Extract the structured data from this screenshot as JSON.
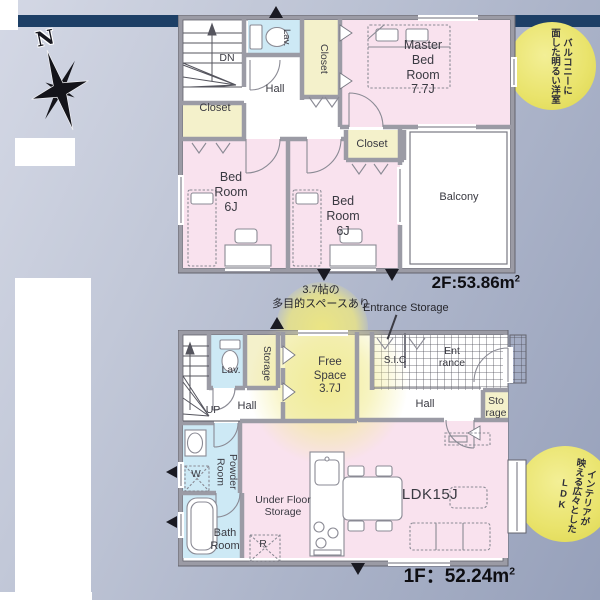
{
  "colors": {
    "top_bar": "#1d3f66",
    "wall": "#9b9ba5",
    "room_pink": "#f9e2ee",
    "room_yellow": "#f4f1cb",
    "room_blue": "#cde9f5",
    "badge_yellow": "#e9e36b"
  },
  "compass": {
    "north": "N"
  },
  "floor2": {
    "area": {
      "value": "2F:53.86m",
      "sup": "2"
    },
    "labels": {
      "dn": "DN",
      "lav": "Lav.",
      "closet_top": "Closet",
      "closet_left": "Closet",
      "closet_mid": "Closet",
      "hall": "Hall",
      "master": "Master Bed Room",
      "master_size": "7.7J",
      "bed1": "Bed Room",
      "bed1_size": "6J",
      "bed2": "Bed Room",
      "bed2_size": "6J",
      "balcony": "Balcony"
    },
    "badge": {
      "line1": "バルコニーに",
      "line2": "面した明るい洋室"
    }
  },
  "middle": {
    "callout_line1": "3.7帖の",
    "callout_line2": "多目的スペースあり",
    "entrance_storage": "Entrance Storage"
  },
  "floor1": {
    "area": {
      "value": "1F：52.24m",
      "sup": "2"
    },
    "labels": {
      "up": "UP",
      "lav": "Lav.",
      "storage": "Storage",
      "free": "Free Space",
      "free_size": "3.7J",
      "sic": "S.I.C",
      "entrance": "Ent rance",
      "hall_left": "Hall",
      "hall_right": "Hall",
      "storage_small": "Sto rage",
      "powder": "Powder Room",
      "bath": "Bath Room",
      "washer": "W",
      "fridge": "R",
      "under_floor": "Under Floor Storage",
      "ldk": "LDK15J"
    },
    "badge": {
      "line1": "インテリアが",
      "line2": "映える広々とした",
      "line3": "LDK"
    }
  }
}
